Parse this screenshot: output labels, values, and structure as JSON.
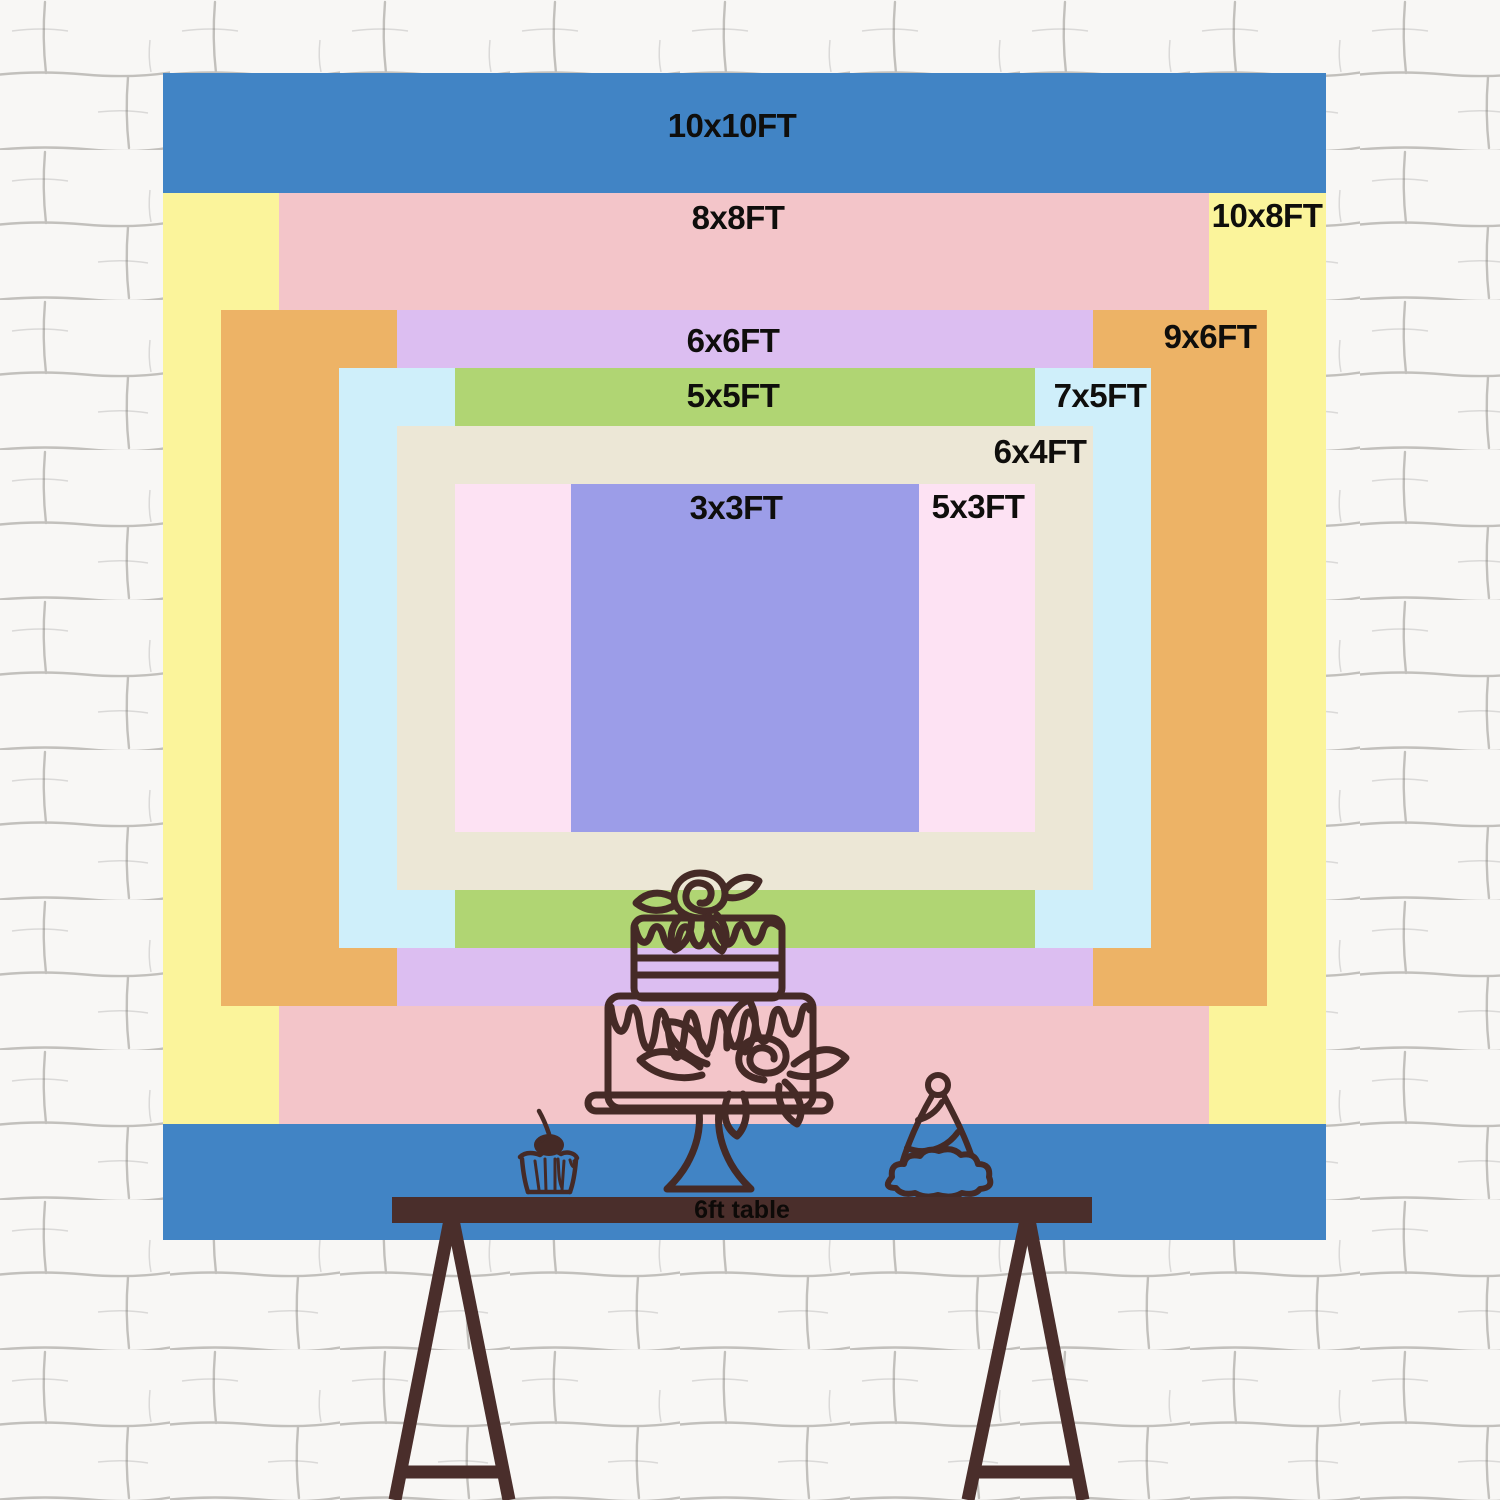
{
  "chart": {
    "sizes": [
      {
        "label": "10x10FT",
        "color": "#4184C5"
      },
      {
        "label": "8x8FT",
        "color": "#F3C5C9"
      },
      {
        "label": "10x8FT",
        "color": "#FBF49B"
      },
      {
        "label": "6x6FT",
        "color": "#DCBEF1"
      },
      {
        "label": "9x6FT",
        "color": "#EDB366"
      },
      {
        "label": "5x5FT",
        "color": "#B0D573"
      },
      {
        "label": "7x5FT",
        "color": "#CFEFFA"
      },
      {
        "label": "6x4FT",
        "color": "#ECE7D6"
      },
      {
        "label": "3x3FT",
        "color": "#9C9DE8"
      },
      {
        "label": "5x3FT",
        "color": "#FDE2F3"
      }
    ],
    "table_label": "6ft table",
    "illustrations": [
      "two-tier-birthday-cake-on-stand",
      "cupcake-with-cherry",
      "party-hat"
    ],
    "colors": {
      "wall": "#F8F7F5",
      "mortar": "#8C8984",
      "table": "#4A2E2B",
      "line": "#452A26",
      "text": "#0F0E0C"
    }
  }
}
